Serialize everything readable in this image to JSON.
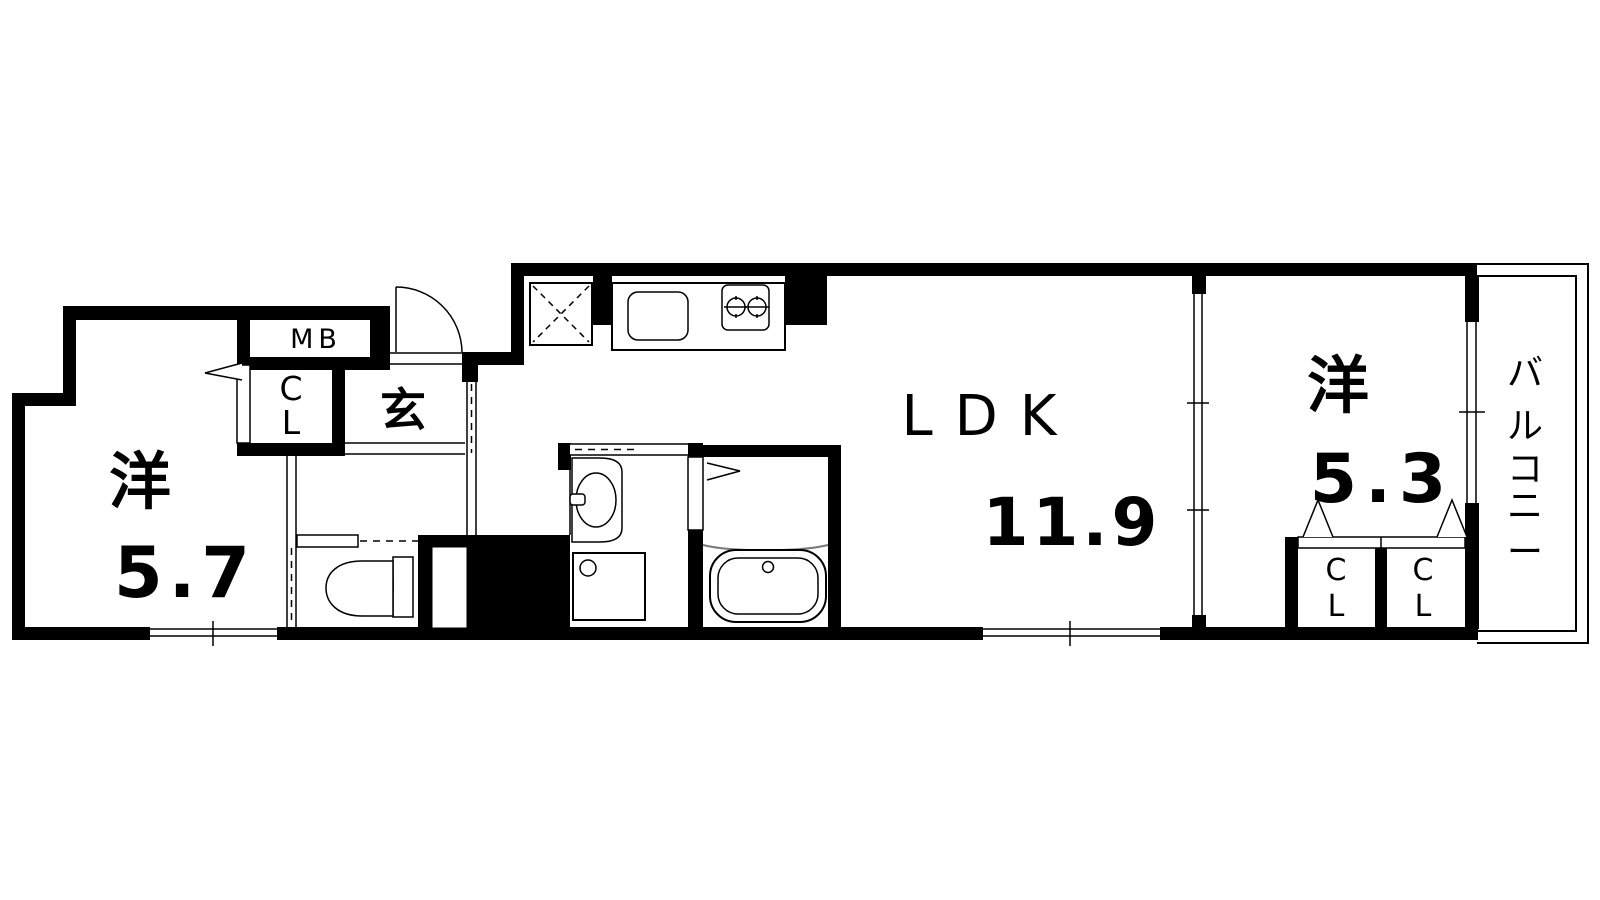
{
  "plan": {
    "type": "apartment-floor-plan",
    "room_left": {
      "name": "洋",
      "size": "5.7"
    },
    "ldk": {
      "name": "LDK",
      "size": "11.9"
    },
    "room_right": {
      "name": "洋",
      "size": "5.3"
    },
    "entrance_label": "玄",
    "meter_box_label": "MB",
    "closet_letters": {
      "c": "C",
      "l": "L"
    },
    "balcony_label": "バルコニー",
    "balcony_chars": [
      "バ",
      "ル",
      "コ",
      "ニ",
      "ー"
    ],
    "colors": {
      "wall": "#000000",
      "background": "#ffffff",
      "fixture_line": "#000000",
      "water_line": "#7a7a7a"
    }
  }
}
